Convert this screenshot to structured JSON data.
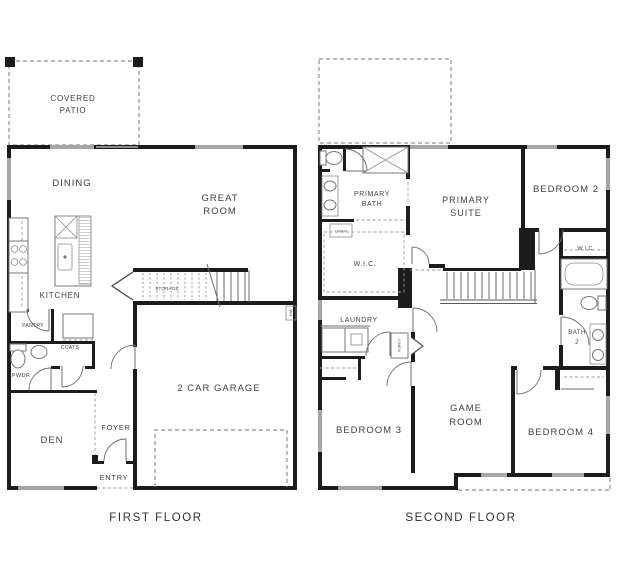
{
  "colors": {
    "wall": "#1c1c1c",
    "window": "#a6a6a6",
    "line": "#6b6b6b",
    "dashed": "#8f8f8f",
    "text": "#3f3f3f",
    "background": "#ffffff"
  },
  "first_floor": {
    "caption": "FIRST FLOOR",
    "labels": {
      "covered_patio_1": "COVERED",
      "covered_patio_2": "PATIO",
      "dining": "DINING",
      "great_room_1": "GREAT",
      "great_room_2": "ROOM",
      "kitchen": "KITCHEN",
      "pantry": "PANTRY",
      "coats": "COATS",
      "powder": "PWDR",
      "storage": "STORAGE",
      "water_heater": "WH",
      "garage": "2 CAR GARAGE",
      "foyer": "FOYER",
      "entry": "ENTRY",
      "den": "DEN"
    }
  },
  "second_floor": {
    "caption": "SECOND FLOOR",
    "labels": {
      "primary_bath_1": "PRIMARY",
      "primary_bath_2": "BATH",
      "linen_bath": "LINEN",
      "wic_primary": "W.I.C.",
      "primary_suite_1": "PRIMARY",
      "primary_suite_2": "SUITE",
      "bedroom2": "BEDROOM 2",
      "wic_2": "W.I.C.",
      "laundry": "LAUNDRY",
      "linen_hall": "LINEN",
      "bath2_1": "BATH",
      "bath2_2": "2",
      "bedroom3": "BEDROOM 3",
      "game_room_1": "GAME",
      "game_room_2": "ROOM",
      "bedroom4": "BEDROOM 4"
    }
  }
}
